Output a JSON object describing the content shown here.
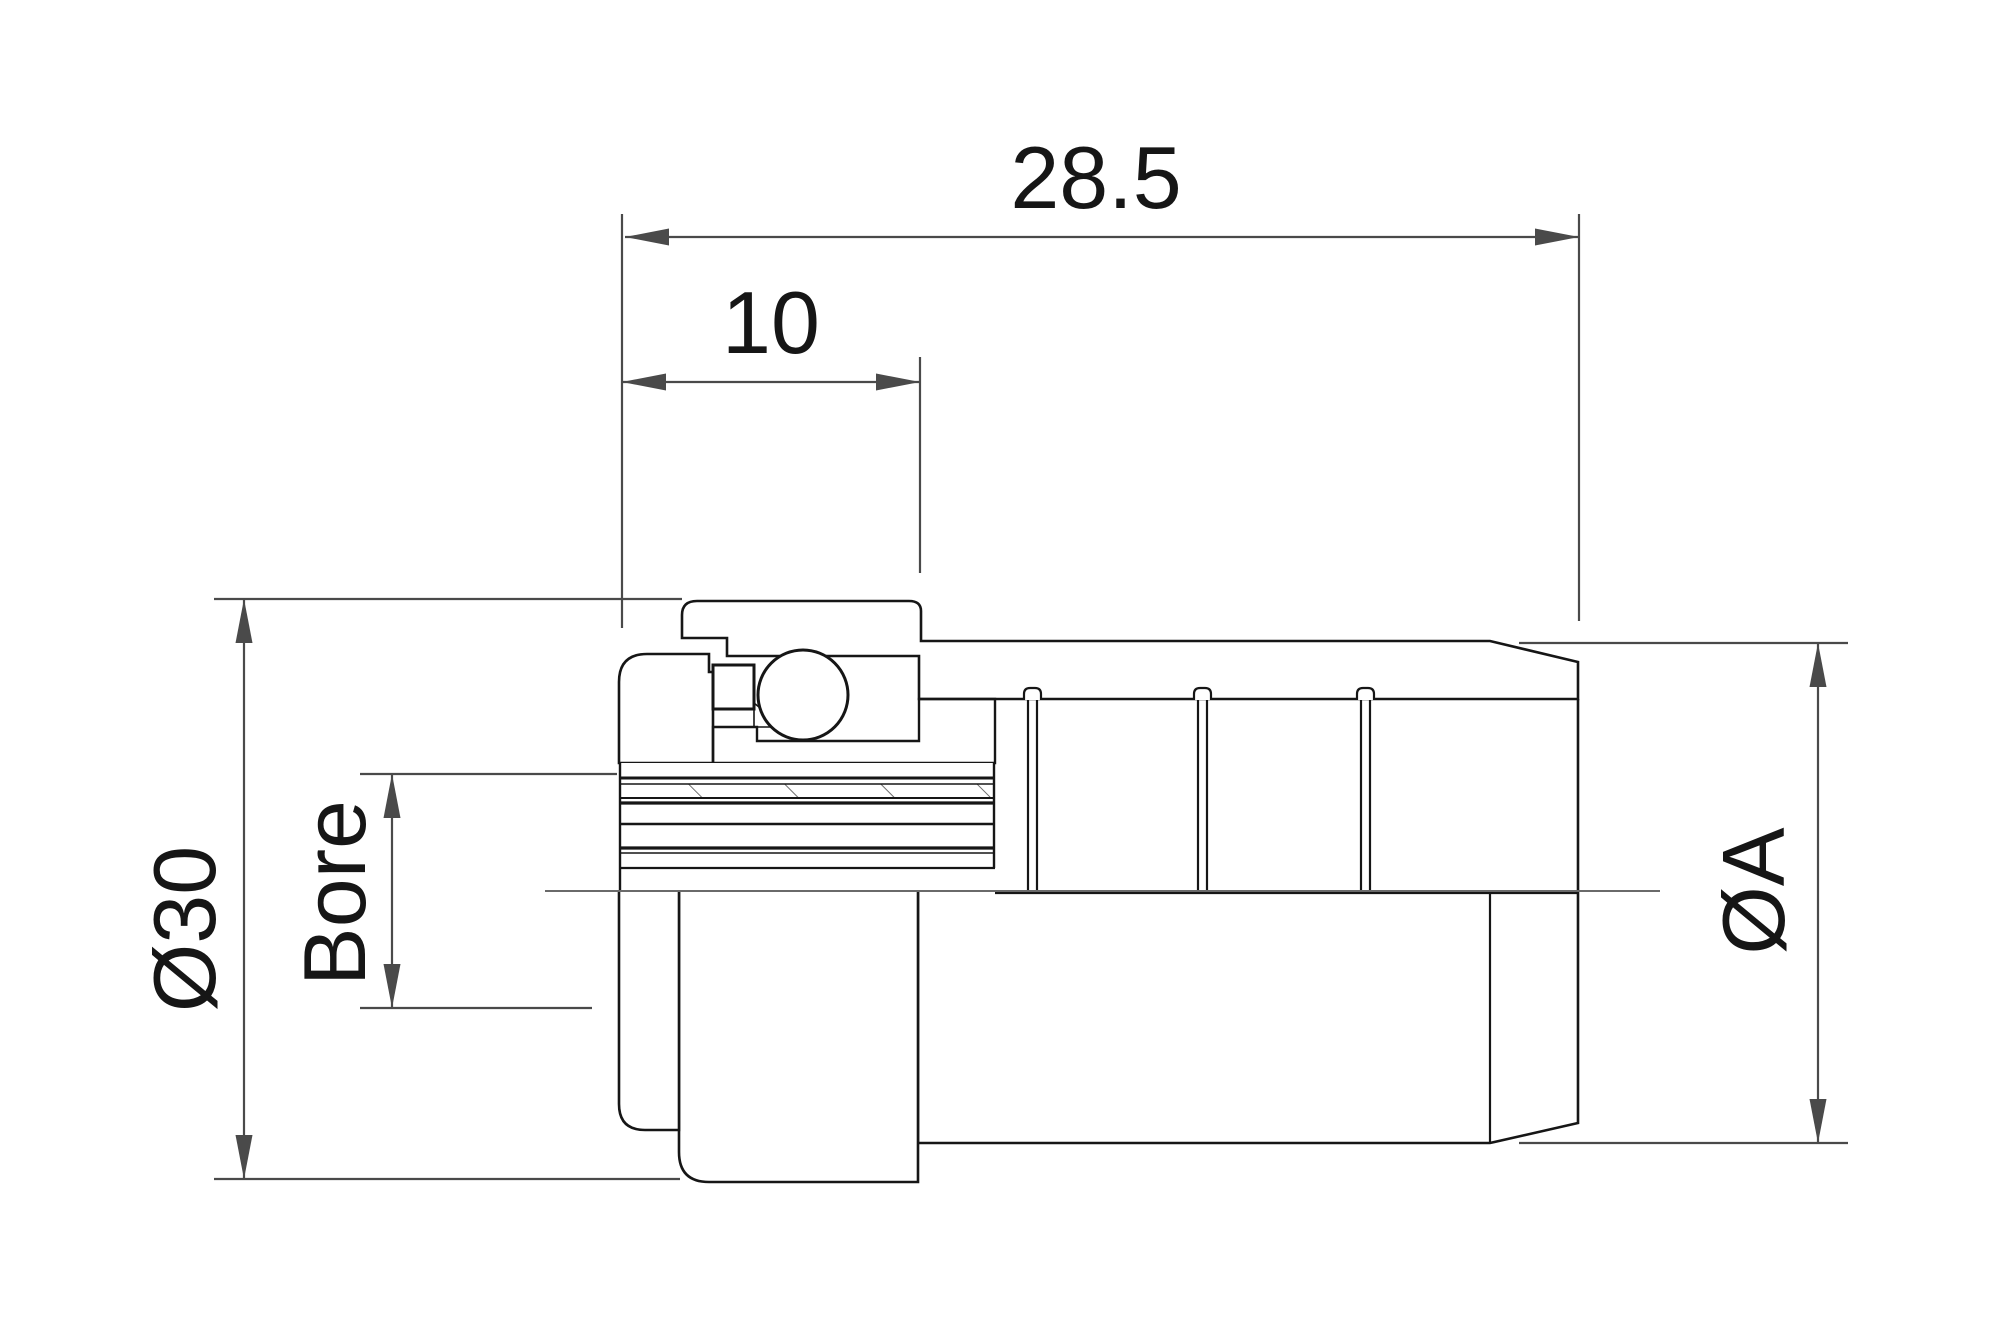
{
  "drawing": {
    "type": "technical-drawing",
    "subject": "bearing and pulley assembly cross-section",
    "background_color": "#ffffff",
    "part_line_color": "#161616",
    "dimension_color": "#4a4a4a",
    "hatch_color": "#555555",
    "dimensions": [
      {
        "id": "overall-length",
        "label": "28.5",
        "orientation": "horizontal",
        "position": "top"
      },
      {
        "id": "pilot-length",
        "label": "10",
        "orientation": "horizontal",
        "position": "top-inner"
      },
      {
        "id": "outer-diameter",
        "label": "Ø30",
        "orientation": "vertical",
        "position": "left"
      },
      {
        "id": "bore-diameter",
        "label": "Bore",
        "orientation": "vertical",
        "position": "left-inner"
      },
      {
        "id": "body-diameter",
        "label": "ØA",
        "orientation": "vertical",
        "position": "right"
      }
    ]
  }
}
